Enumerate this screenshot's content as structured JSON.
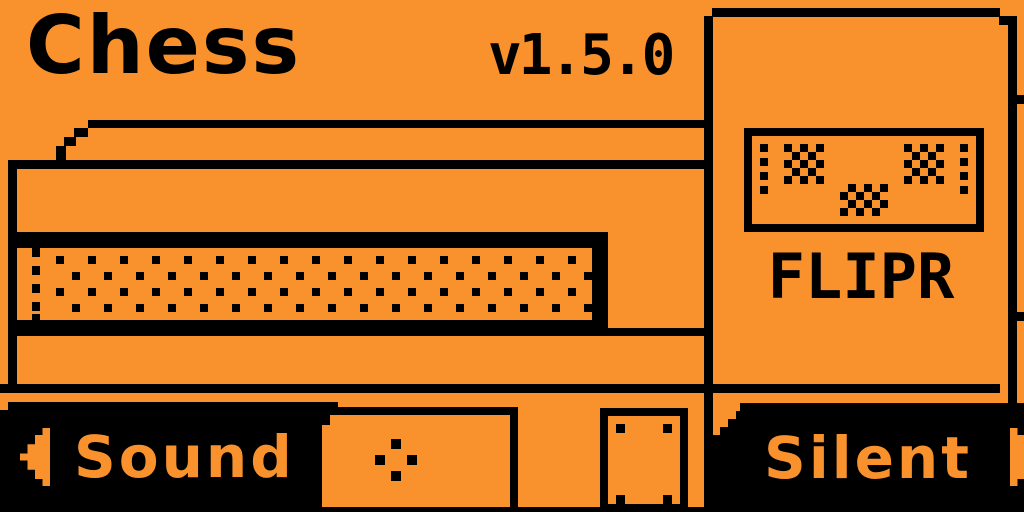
{
  "header": {
    "title": "Chess",
    "version": "v1.5.0"
  },
  "device_panel": {
    "label": "FLIPR",
    "face_icon": "checker-face"
  },
  "footer": {
    "left_button": {
      "label": "Sound",
      "icon": "left-arrow"
    },
    "center_button": {
      "icon": "ok-diamond"
    },
    "right_button": {
      "label": "Silent",
      "icon": "right-arrow"
    }
  },
  "colors": {
    "background": "#F9912D",
    "foreground": "#000000"
  }
}
